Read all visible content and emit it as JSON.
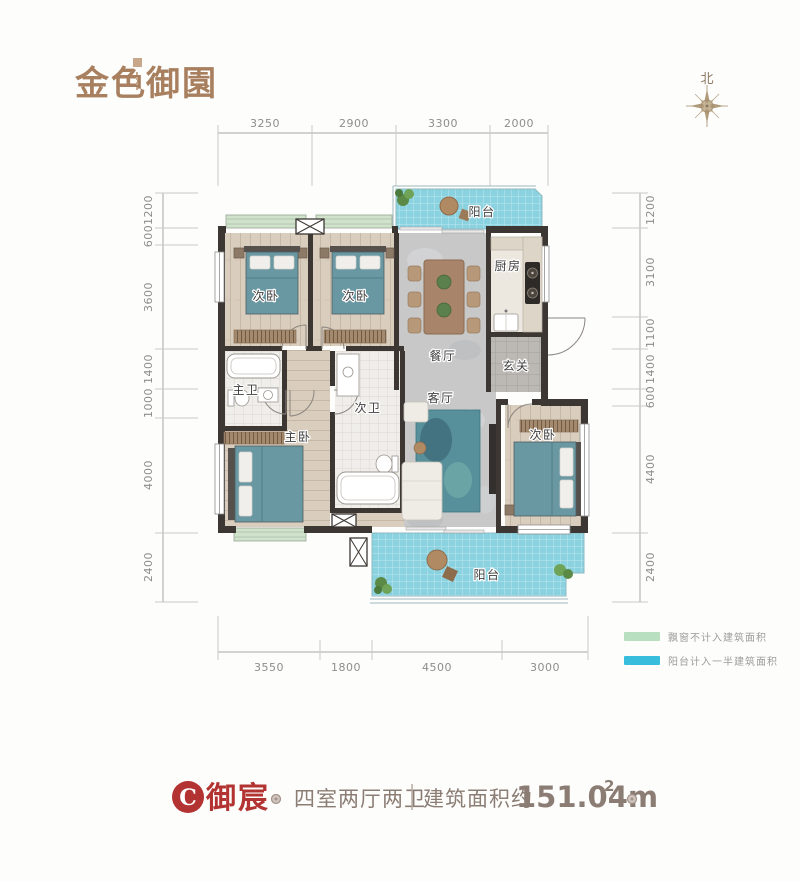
{
  "logo": {
    "part1": "金色",
    "part2": "御園"
  },
  "compass": {
    "north": "北"
  },
  "dims": {
    "top": [
      "3250",
      "2900",
      "3300",
      "2000"
    ],
    "bottom": [
      "3550",
      "1800",
      "4500",
      "3000"
    ],
    "left": [
      "1200",
      "600",
      "3600",
      "1400",
      "1000",
      "4000",
      "2400"
    ],
    "right": [
      "1200",
      "3100",
      "1100",
      "1400",
      "600",
      "4400",
      "2400"
    ]
  },
  "rooms": {
    "bedroom_a": "次卧",
    "bedroom_b": "次卧",
    "bedroom_c": "次卧",
    "master_bedroom": "主卧",
    "master_bath": "主卫",
    "second_bath": "次卫",
    "dining": "餐厅",
    "living": "客厅",
    "kitchen": "厨房",
    "foyer": "玄关",
    "balcony_top": "阳台",
    "balcony_bottom": "阳台"
  },
  "legend": {
    "items": [
      {
        "label": "飘窗不计入建筑面积",
        "color": "#b9dfc1"
      },
      {
        "label": "阳台计入一半建筑面积",
        "color": "#38bedc"
      }
    ]
  },
  "title": {
    "badge": "C",
    "name": "御宸",
    "layout": "四室两厅两卫",
    "area_label": "建筑面积约",
    "area_value": "151.04m",
    "area_sup": "2"
  },
  "colors": {
    "accent_red": "#b23331",
    "wall": "#3d3733",
    "balcony_blue": "#8ad2e0",
    "bay_green": "#cfe3cb",
    "bed_teal": "#6a98a2",
    "text_brown": "#8b7d74",
    "logo_brown": "#a8805f"
  }
}
